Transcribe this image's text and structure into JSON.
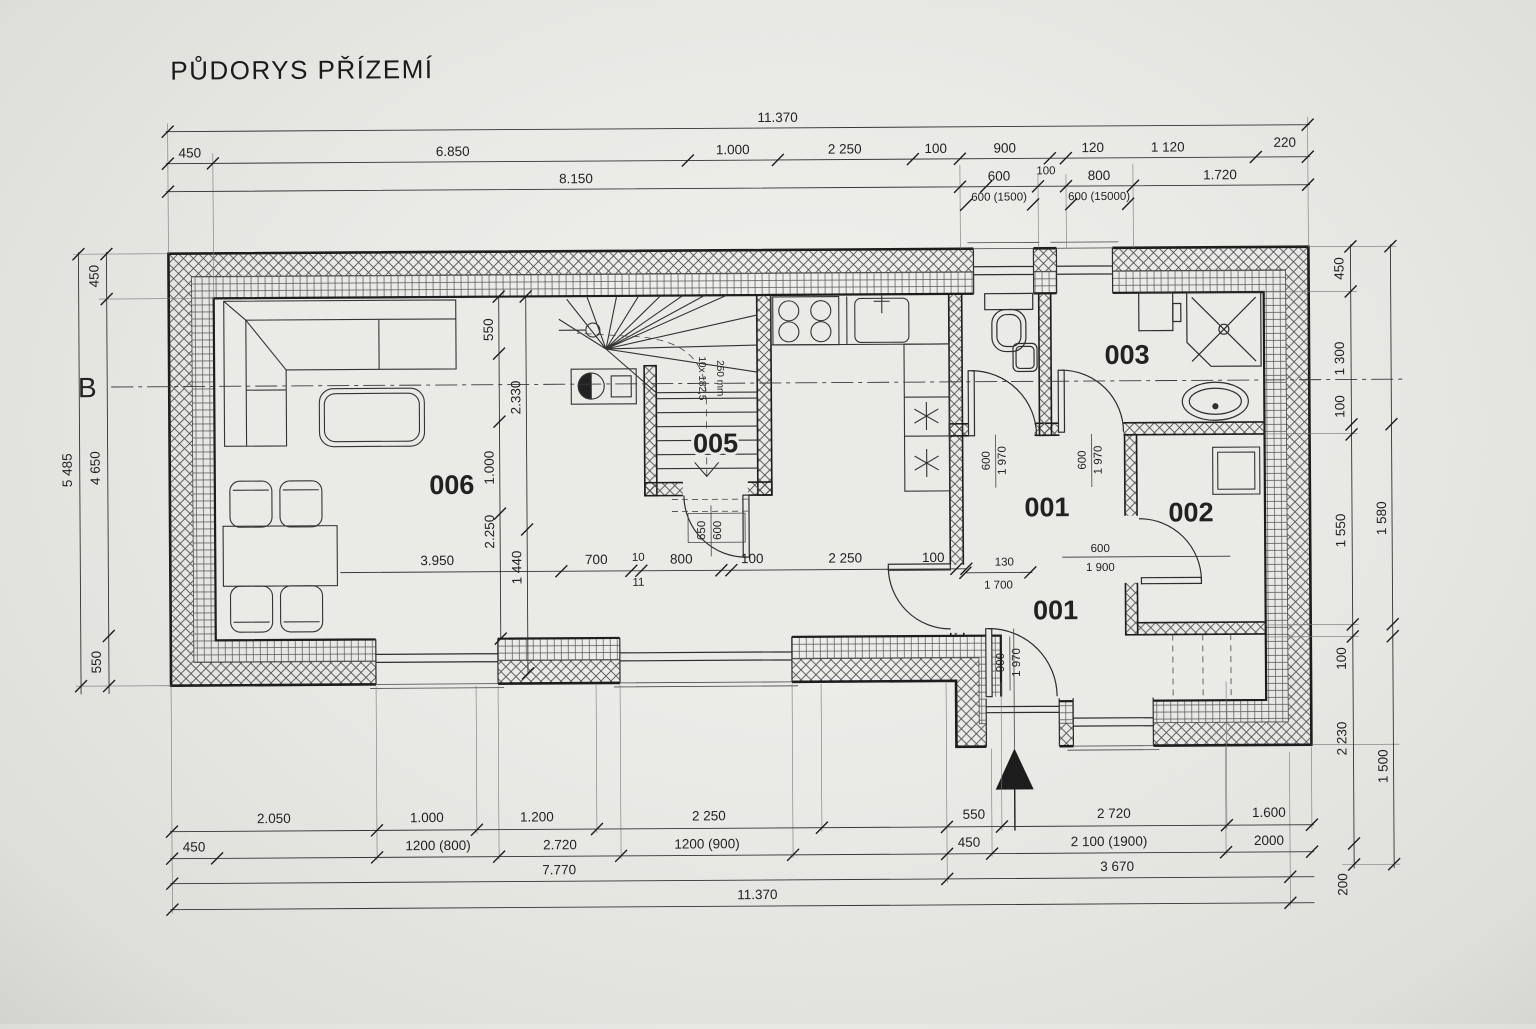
{
  "title": "PŮDORYS PŘÍZEMÍ",
  "section_label": "B",
  "rooms": {
    "living": "006",
    "stairs": "005",
    "hall_upper": "001",
    "hall_lower": "001",
    "bedroom": "002",
    "bathroom": "003"
  },
  "stairs_note": {
    "line1": "10x 182,5",
    "line2": "250 mm"
  },
  "top_dims": {
    "total": "11.370",
    "row2": [
      "450",
      "6.850",
      "1.000",
      "2 250",
      "100",
      "900",
      "120",
      "1 120",
      "220"
    ],
    "row3_left": "8.150",
    "row3_mid": "100",
    "row3": [
      "600",
      "800",
      "1.720"
    ],
    "row4": [
      "600 (1500)",
      "600 (15000)"
    ]
  },
  "left_dims": {
    "outer": "5 485",
    "inner": [
      "450",
      "4 650",
      "550"
    ]
  },
  "right_dims": {
    "inner": [
      "450",
      "1 300",
      "100",
      "1 550",
      "100",
      "2 230",
      "200"
    ],
    "outer": [
      "1 580",
      "1 500"
    ]
  },
  "bottom_dims": {
    "row1": [
      "2.050",
      "1.000",
      "1.200",
      "2 250",
      "550",
      "2 720",
      "1.600"
    ],
    "row2": [
      "450",
      "1200 (800)",
      "2.720",
      "1200 (900)",
      "450",
      "2 100 (1900)",
      "2000"
    ],
    "row3": [
      "7.770",
      "3 670"
    ],
    "total": "11.370"
  },
  "interior_dims": {
    "d3950": "3.950",
    "d700": "700",
    "d10": "10",
    "d11": "11",
    "d800": "800",
    "d100a": "100",
    "d2250": "2 250",
    "d100b": "100",
    "v550": "550",
    "v2330": "2.330",
    "v1000": "1.000",
    "v2250": "2.250",
    "v1440": "1 440",
    "d130": "130",
    "d1700": "1 700",
    "d600": "600",
    "d1900": "1 900"
  },
  "door_dims": {
    "wc": [
      "600",
      "1 970"
    ],
    "bath": [
      "600",
      "1 970"
    ],
    "entry": [
      "900",
      "1 970"
    ],
    "stairs": [
      "650",
      "600"
    ]
  }
}
